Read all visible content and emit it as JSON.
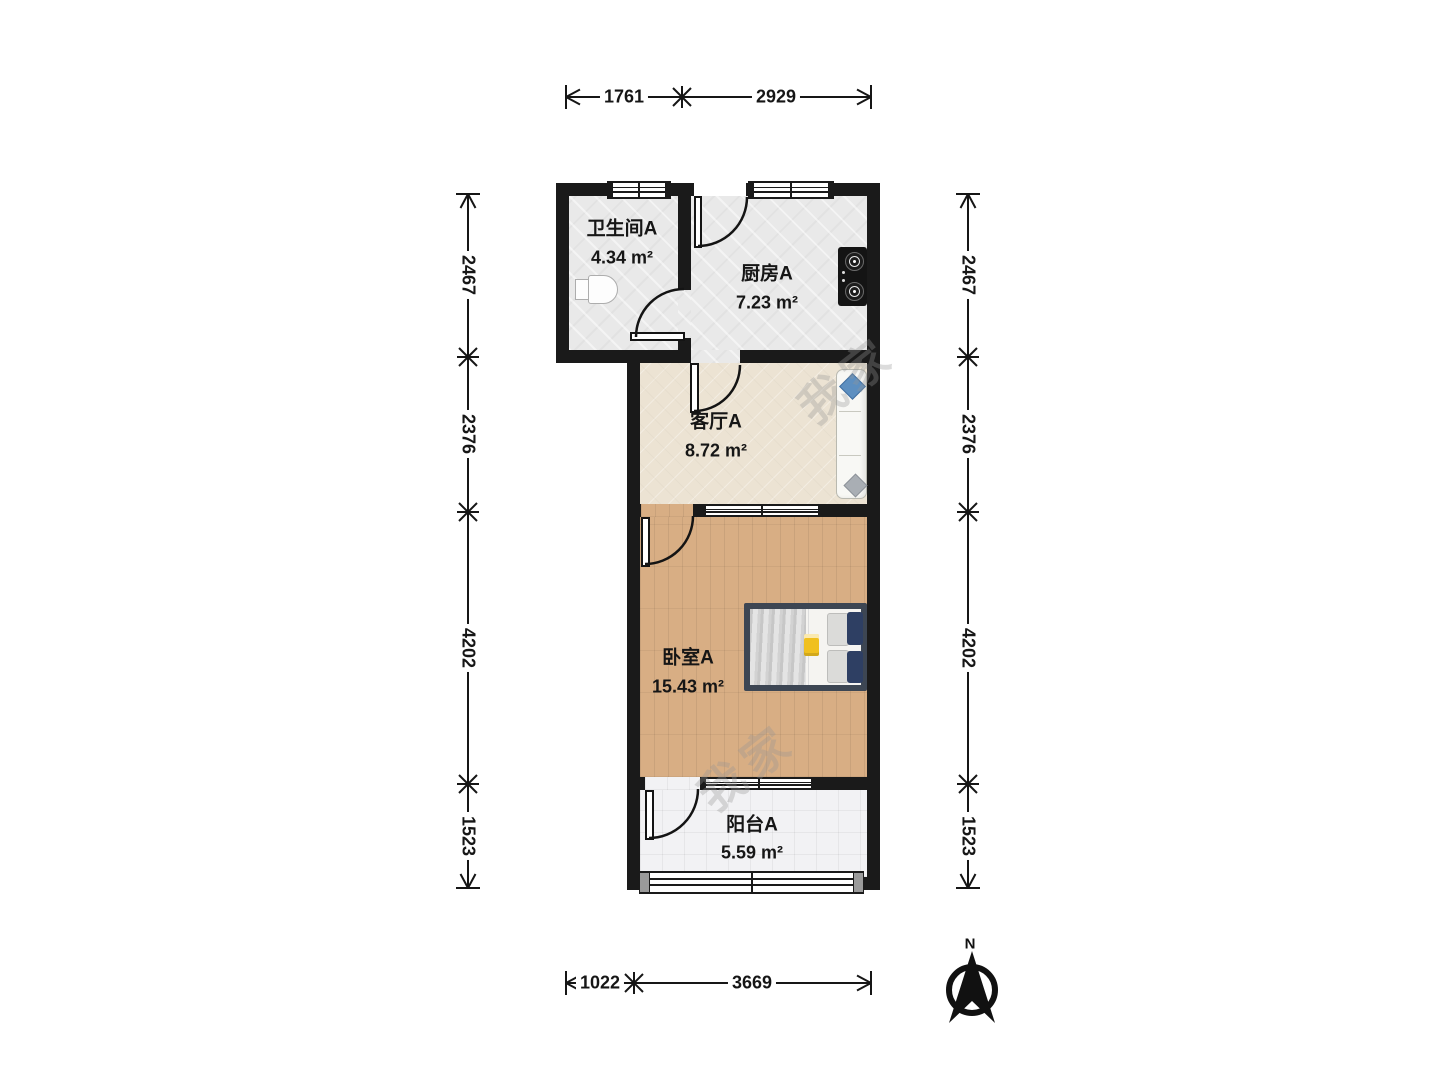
{
  "rooms": {
    "bathroom": {
      "name": "卫生间A",
      "area": "4.34 m²"
    },
    "kitchen": {
      "name": "厨房A",
      "area": "7.23 m²"
    },
    "living": {
      "name": "客厅A",
      "area": "8.72 m²"
    },
    "bedroom": {
      "name": "卧室A",
      "area": "15.43 m²"
    },
    "balcony": {
      "name": "阳台A",
      "area": "5.59 m²"
    }
  },
  "dimensions": {
    "top": [
      "1761",
      "2929"
    ],
    "bottom": [
      "1022",
      "3669"
    ],
    "left": [
      "2467",
      "2376",
      "4202",
      "1523"
    ],
    "right": [
      "2467",
      "2376",
      "4202",
      "1523"
    ]
  },
  "compass": {
    "label": "N"
  },
  "watermark": {
    "text": "我家"
  },
  "colors": {
    "wall": "#1a1a1a",
    "tile_floor": "#e9e9e9",
    "living_floor": "#ece3d3",
    "wood_floor": "#d8ae84",
    "balcony_floor": "#f2f2f4",
    "bed_frame": "#3d4653",
    "pillow_navy": "#2e3f63",
    "sofa_pillow_blue": "#5d8fc0",
    "book_yellow": "#f0c01f"
  }
}
